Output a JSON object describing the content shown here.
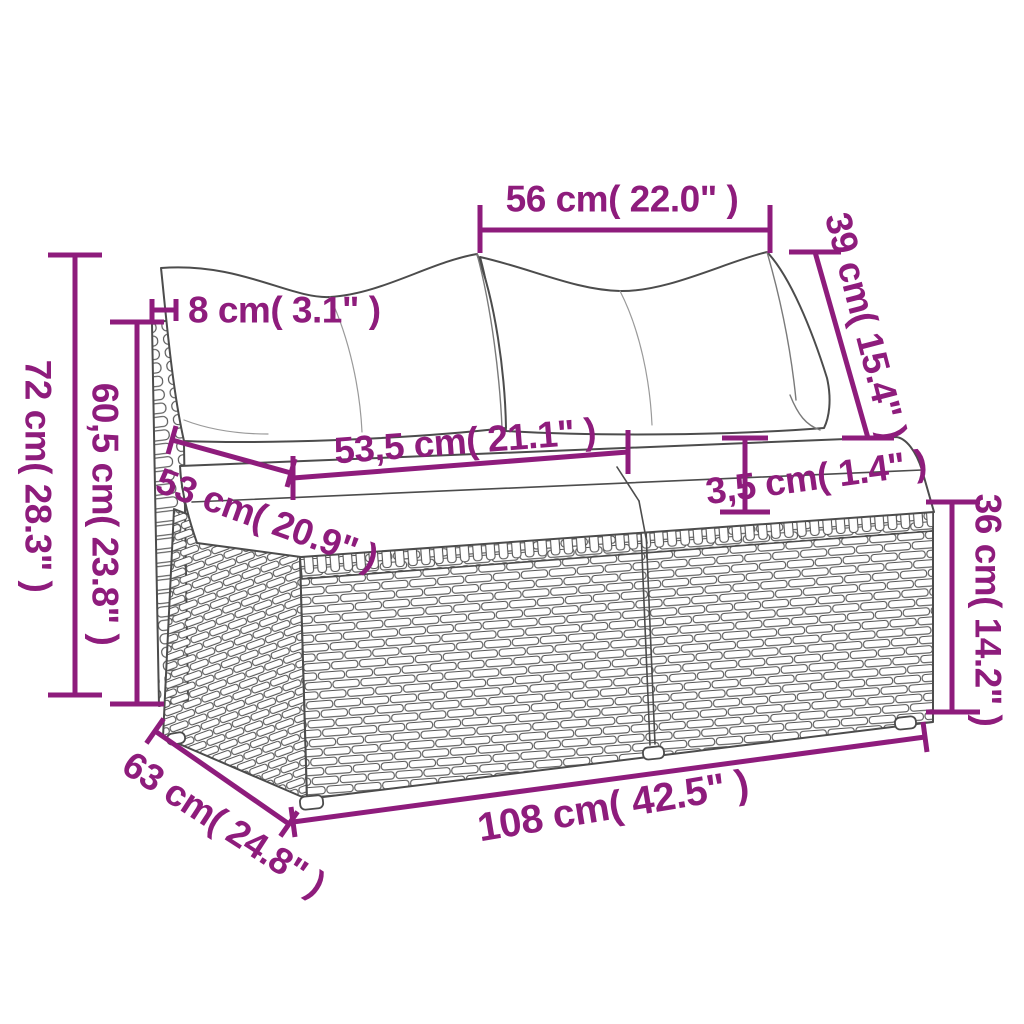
{
  "figure": {
    "illustration_alt": "Poly rattan two-seat garden sofa section with seat cushions and back pillows, line drawing",
    "accent_color": "#8e1c7c",
    "line_color": "#4c4c4c",
    "background": "#ffffff",
    "dimensions": [
      {
        "id": "pillow-width",
        "label": "56 cm( 22.0\" )"
      },
      {
        "id": "pillow-height",
        "label": "39 cm( 15.4\" )"
      },
      {
        "id": "back-panel-thickness",
        "label": "8 cm( 3.1\" )"
      },
      {
        "id": "total-height",
        "label": "72 cm( 28.3\" )"
      },
      {
        "id": "back-height",
        "label": "60,5 cm( 23.8\" )"
      },
      {
        "id": "cushion-width",
        "label": "53,5 cm( 21.1\" )"
      },
      {
        "id": "seat-depth-top",
        "label": "53 cm( 20.9\" )"
      },
      {
        "id": "cushion-thickness",
        "label": "3,5 cm( 1.4\" )"
      },
      {
        "id": "base-height",
        "label": "36 cm( 14.2\" )"
      },
      {
        "id": "seat-depth-bottom",
        "label": "63 cm( 24.8\" )"
      },
      {
        "id": "total-width",
        "label": "108 cm( 42.5\" )"
      }
    ]
  }
}
